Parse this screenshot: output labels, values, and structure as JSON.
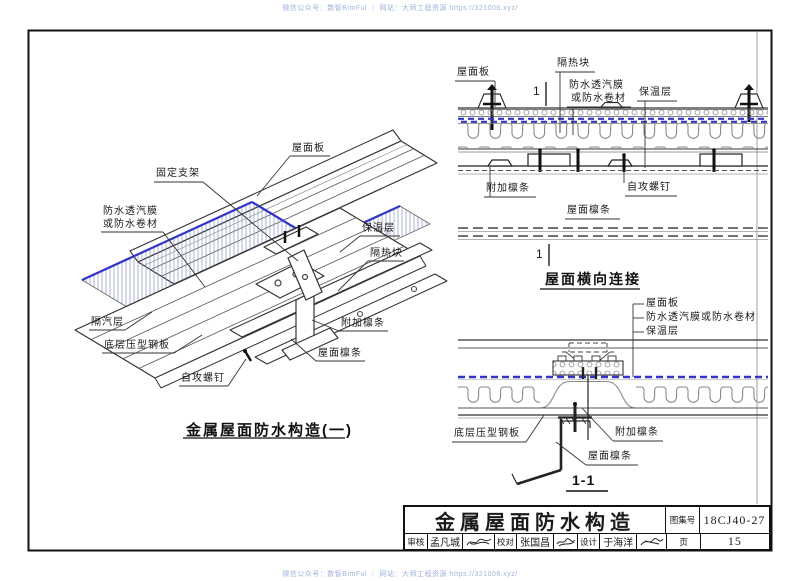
{
  "watermark": "微信公众号：数智BimFul ｜ 网站：大师工程资源 https://321006.xyz/",
  "colors": {
    "membrane_blue": "#3434c8",
    "hatch_blue": "#8a92c8",
    "line_dark": "#1a1a1a",
    "line_gray": "#8a8a8a",
    "watermark_blue": "#9fb3dd"
  },
  "left_diagram": {
    "labels": {
      "roof_panel": "屋面板",
      "fixed_bracket": "固定支架",
      "membrane_1": "防水透汽膜",
      "membrane_2": "或防水卷材",
      "insulation": "保温层",
      "thermal_block": "隔热块",
      "vapor_barrier": "隔汽层",
      "bottom_sheet": "底层压型钢板",
      "screw": "自攻螺钉",
      "added_purlin": "附加檩条",
      "roof_purlin": "屋面檩条"
    },
    "title": "金属屋面防水构造(一)"
  },
  "right_top_diagram": {
    "labels": {
      "roof_panel": "屋面板",
      "thermal_block": "隔热块",
      "membrane_1": "防水透汽膜",
      "membrane_2": "或防水卷材",
      "insulation": "保温层",
      "added_purlin": "附加檩条",
      "screw": "自攻螺钉",
      "roof_purlin": "屋面檩条"
    },
    "section_mark": "1",
    "title": "屋面横向连接"
  },
  "right_bottom_diagram": {
    "labels": {
      "roof_panel": "屋面板",
      "membrane": "防水透汽膜或防水卷材",
      "insulation": "保温层",
      "bottom_sheet": "底层压型钢板",
      "added_purlin": "附加檩条",
      "roof_purlin": "屋面檩条"
    },
    "title": "1-1"
  },
  "title_block": {
    "title": "金属屋面防水构造",
    "atlas_label": "图集号",
    "atlas_number": "18CJ40-27",
    "page_label": "页",
    "page_number": "15",
    "review_label": "审核",
    "reviewer": "孟凡城",
    "check_label": "校对",
    "checker": "张国昌",
    "design_label": "设计",
    "designer": "于海洋"
  }
}
